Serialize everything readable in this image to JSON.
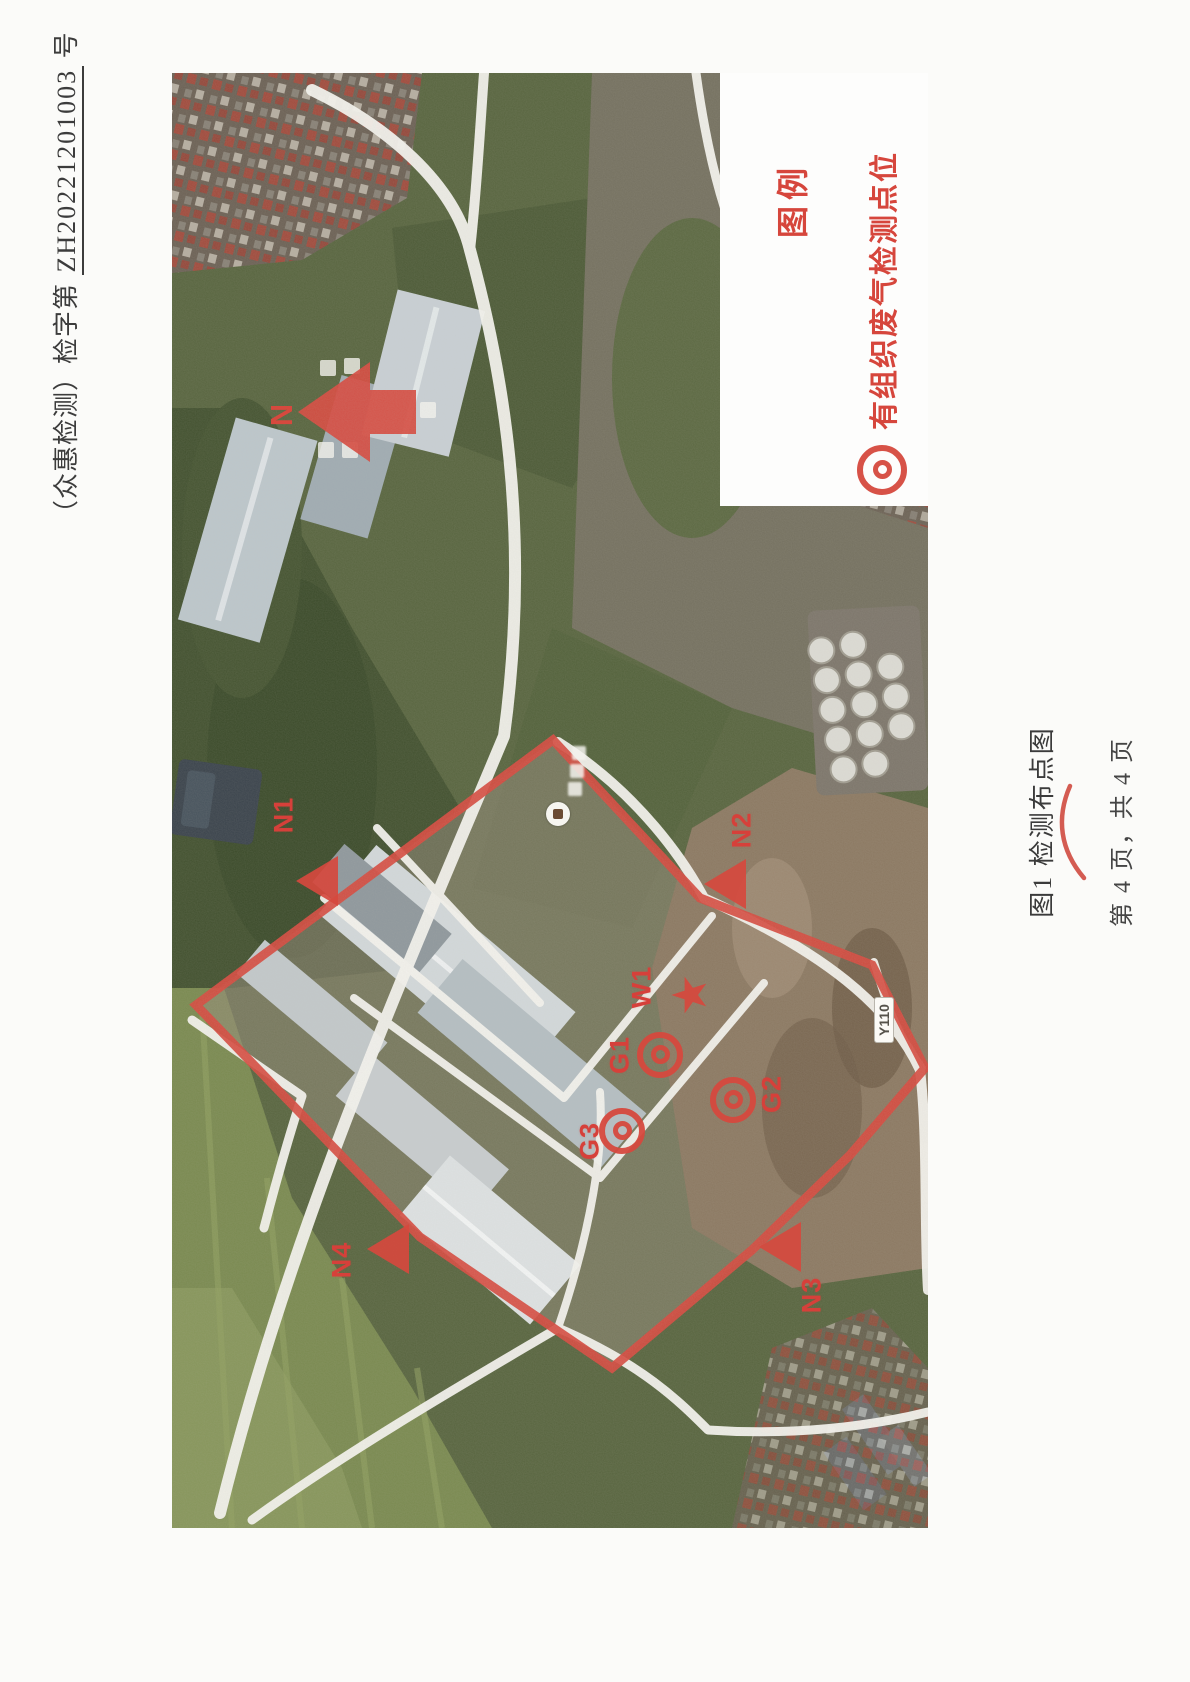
{
  "document": {
    "header": {
      "prefix": "（众惠检测）检字第",
      "number": "ZH20221201003",
      "suffix": "号"
    },
    "figure_caption": "图1 检测布点图",
    "page_footer": "第 4 页，共 4 页"
  },
  "legend": {
    "title": "图例",
    "items": [
      {
        "icon": "double-circle-icon",
        "label": "有组织废气检测点位"
      },
      {
        "icon": "star-icon",
        "label": "废水检测点位"
      },
      {
        "icon": "triangle-icon",
        "label": "噪声检测点位"
      }
    ]
  },
  "map": {
    "north_label": "N",
    "road_label": "Y110",
    "markers": [
      {
        "id": "N1",
        "type": "noise",
        "icon": "triangle-icon"
      },
      {
        "id": "N2",
        "type": "noise",
        "icon": "triangle-icon"
      },
      {
        "id": "N3",
        "type": "noise",
        "icon": "triangle-icon"
      },
      {
        "id": "N4",
        "type": "noise",
        "icon": "triangle-icon"
      },
      {
        "id": "G1",
        "type": "organized-exhaust",
        "icon": "double-circle-icon"
      },
      {
        "id": "G2",
        "type": "organized-exhaust",
        "icon": "double-circle-icon"
      },
      {
        "id": "G3",
        "type": "organized-exhaust",
        "icon": "double-circle-icon"
      },
      {
        "id": "W1",
        "type": "wastewater",
        "icon": "star-icon"
      }
    ]
  },
  "colors": {
    "annotation_red": "#d6493e",
    "header_text": "#3c3c3c",
    "legend_background": "#fdfdfc"
  }
}
